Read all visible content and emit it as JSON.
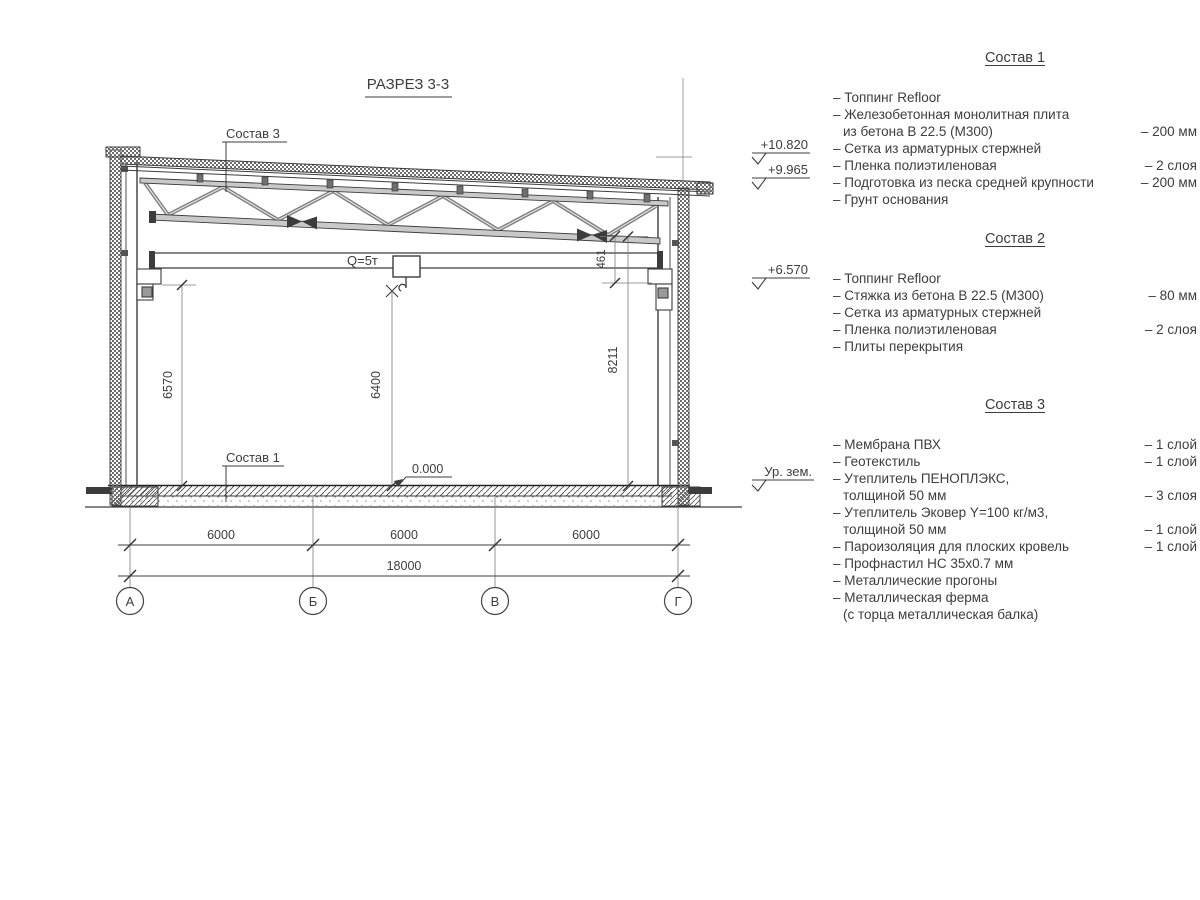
{
  "title": "РАЗРЕЗ 3-3",
  "colors": {
    "line": "#3c3c3c",
    "thin": "#7a7a7a",
    "steel": "#8a8a8a",
    "text": "#3d3d3d"
  },
  "drawing": {
    "callout_roof": "Состав 3",
    "callout_floor": "Состав 1",
    "crane_capacity": "Q=5т",
    "level_zero": "0.000",
    "dim_left_height": "6570",
    "dim_hook_height": "6400",
    "dim_right_height": "8211",
    "dim_gap": "461",
    "spans": [
      "6000",
      "6000",
      "6000"
    ],
    "total_span": "18000",
    "axes": [
      "А",
      "Б",
      "В",
      "Г"
    ],
    "elevations": {
      "parapet": "+10.820",
      "roof_edge": "+9.965",
      "crane_rail": "+6.570",
      "ground": "Ур. зем."
    }
  },
  "legend": {
    "s1": {
      "heading": "Состав 1",
      "items": [
        {
          "t": "– Топпинг Refloor",
          "v": ""
        },
        {
          "t": "– Железобетонная  монолитная плита",
          "v": ""
        },
        {
          "t": "из бетона В 22.5 (М300)",
          "v": "– 200 мм"
        },
        {
          "t": "– Сетка из арматурных стержней",
          "v": ""
        },
        {
          "t": "– Пленка полиэтиленовая",
          "v": "– 2 слоя"
        },
        {
          "t": "– Подготовка из песка средней крупности",
          "v": "– 200 мм"
        },
        {
          "t": "– Грунт основания",
          "v": ""
        }
      ]
    },
    "s2": {
      "heading": "Состав 2",
      "items": [
        {
          "t": "– Топпинг Refloor",
          "v": ""
        },
        {
          "t": "– Стяжка из бетона В 22.5 (М300)",
          "v": "– 80 мм"
        },
        {
          "t": "– Сетка из арматурных стержней",
          "v": ""
        },
        {
          "t": "– Пленка полиэтиленовая",
          "v": "– 2 слоя"
        },
        {
          "t": "– Плиты перекрытия",
          "v": ""
        }
      ]
    },
    "s3": {
      "heading": "Состав 3",
      "items": [
        {
          "t": "– Мембрана ПВХ",
          "v": "– 1 слой"
        },
        {
          "t": "– Геотекстиль",
          "v": "– 1 слой"
        },
        {
          "t": "– Утеплитель ПЕНОПЛЭКС,",
          "v": ""
        },
        {
          "t": "толщиной 50 мм",
          "v": "– 3 слоя"
        },
        {
          "t": "– Утеплитель Эковер Y=100 кг/м3,",
          "v": ""
        },
        {
          "t": "толщиной 50 мм",
          "v": "– 1 слой"
        },
        {
          "t": "– Пароизоляция для плоских кровель",
          "v": "– 1 слой"
        },
        {
          "t": "– Профнастил НС 35х0.7 мм",
          "v": ""
        },
        {
          "t": "– Металлические прогоны",
          "v": ""
        },
        {
          "t": "– Металлическая ферма",
          "v": ""
        },
        {
          "t": "(с торца металлическая балка)",
          "v": ""
        }
      ]
    }
  }
}
